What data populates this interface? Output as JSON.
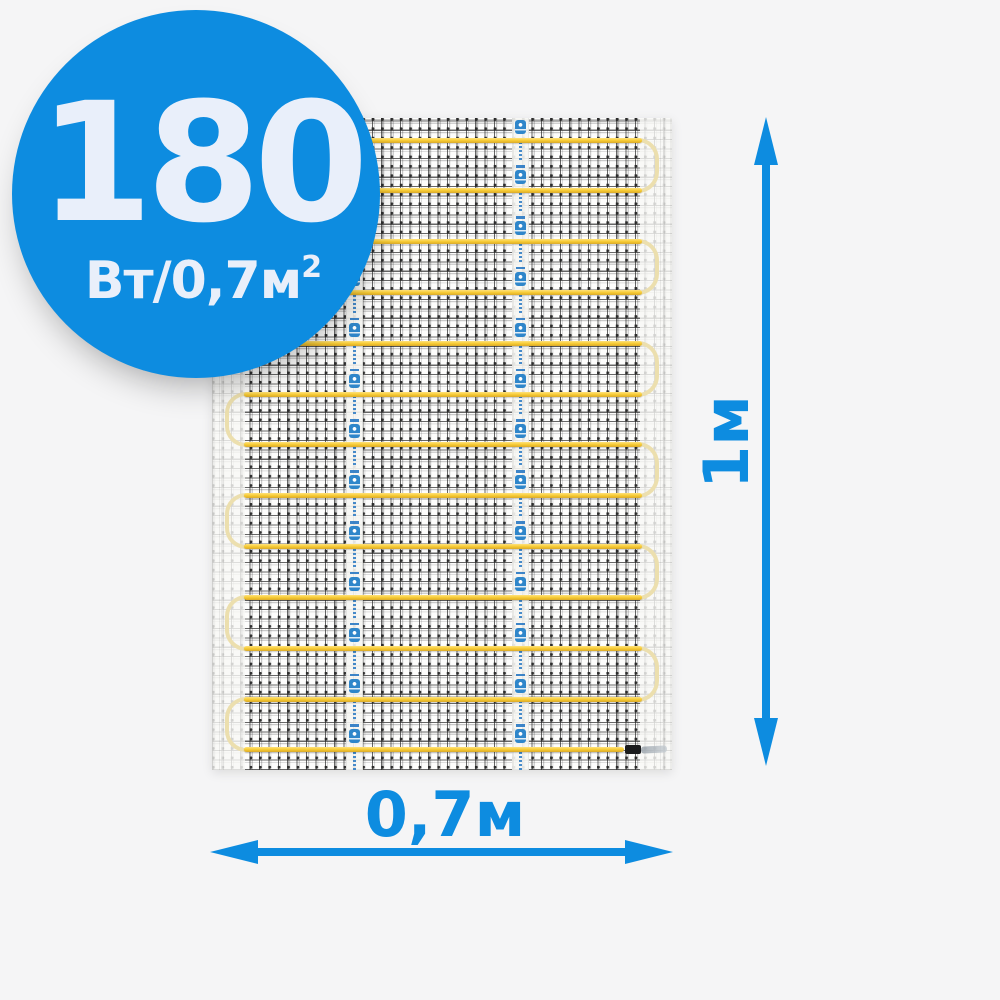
{
  "product": {
    "badge": {
      "value": "180",
      "unit": "Вт/0,7м",
      "unit_sup": "2"
    },
    "dimensions": {
      "height_label": "1м",
      "width_label": "0,7м"
    },
    "mat": {
      "rows": 13,
      "first_row_y": 22,
      "row_spacing": 50.83,
      "right_loop_pairs": [
        [
          0,
          1
        ],
        [
          2,
          3
        ],
        [
          4,
          5
        ],
        [
          6,
          7
        ],
        [
          8,
          9
        ],
        [
          10,
          11
        ]
      ],
      "left_loop_pairs": [
        [
          1,
          2
        ],
        [
          3,
          4
        ],
        [
          5,
          6
        ],
        [
          7,
          8
        ],
        [
          9,
          10
        ],
        [
          11,
          12
        ]
      ],
      "tape_strip_count": 2,
      "tape_marks_per_strip": 14
    }
  },
  "colors": {
    "accent_blue": "#0d8ce0",
    "badge_text": "#e9effa",
    "cable_yellow": "#f5c930",
    "cable_highlight": "#ffe27a",
    "loop_pale": "#ecdfae",
    "background": "#f5f5f6",
    "tape_logo_blue": "#2f86ca",
    "connector_black": "#1a1b1d"
  }
}
